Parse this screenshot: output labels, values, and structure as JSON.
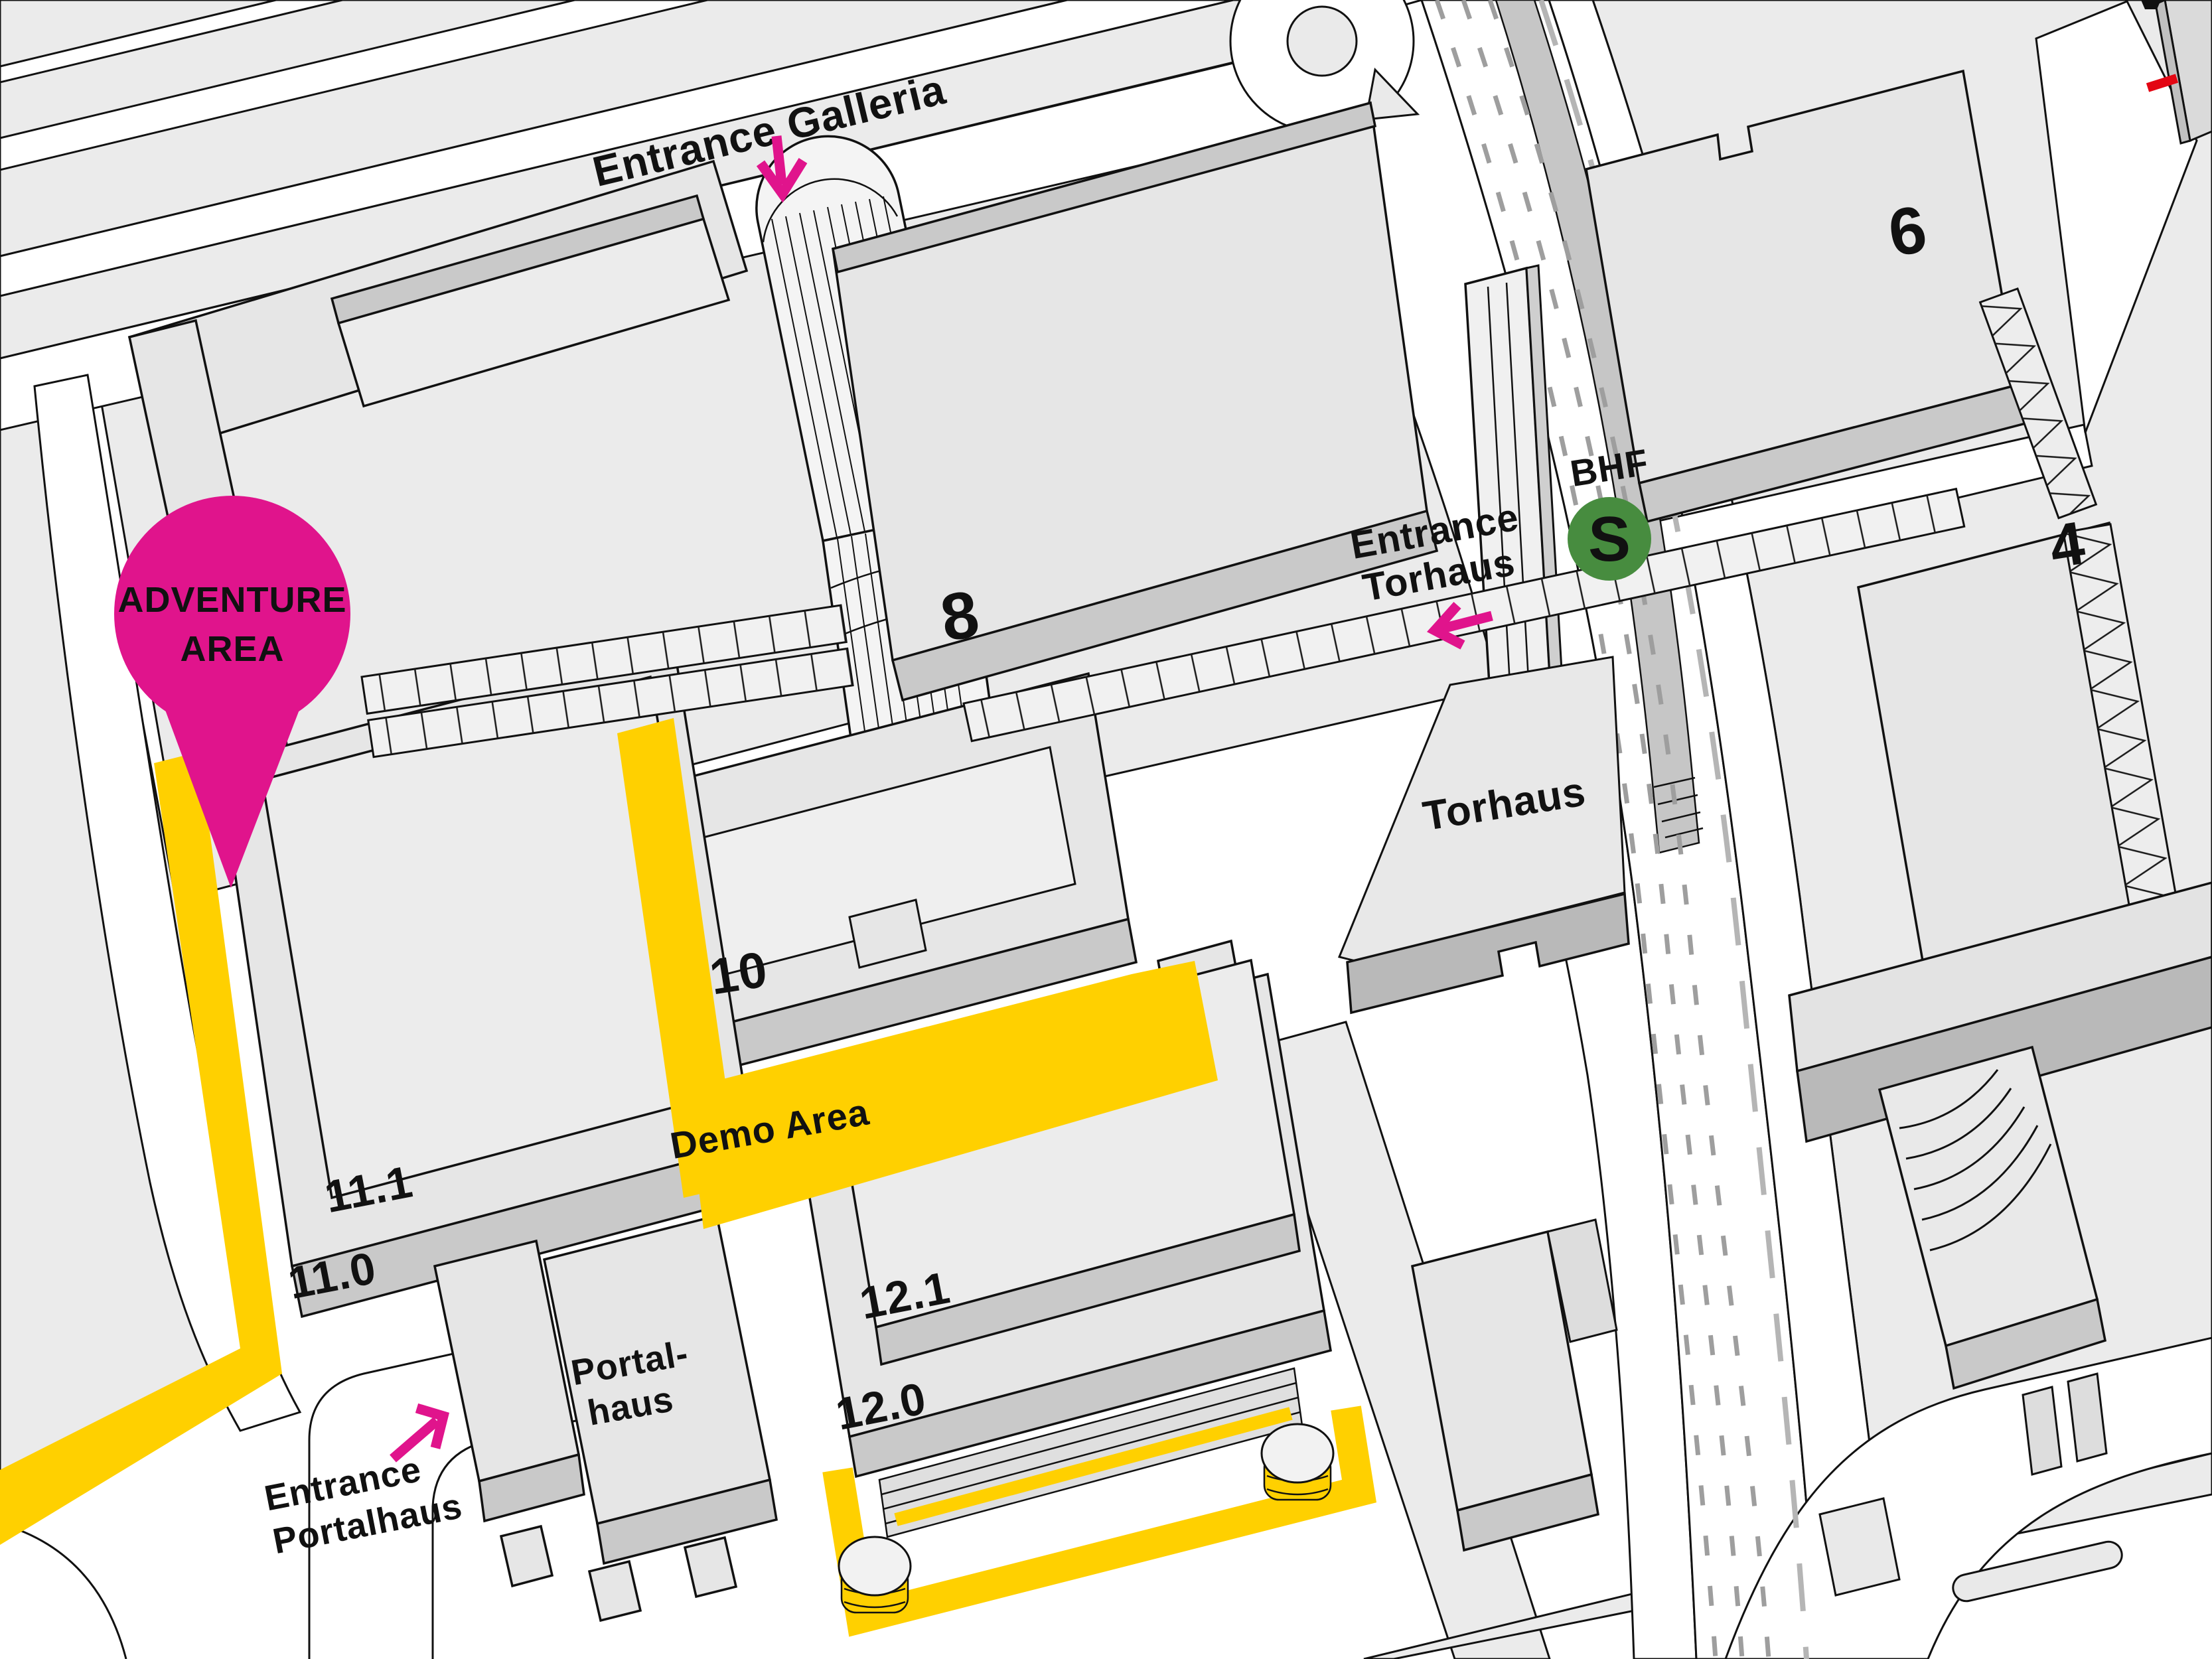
{
  "map": {
    "title": "Exhibition grounds overview map",
    "labels": {
      "entrance_galleria": "Entrance Galleria",
      "hall_9_0": "9.0",
      "hall_8": "8",
      "hall_6": "6",
      "hall_4": "4",
      "entrance_torhaus_line1": "Entrance",
      "entrance_torhaus_line2": "Torhaus",
      "bhf": "BHF",
      "sbahn": "S",
      "torhaus": "Torhaus",
      "pin_line1": "ADVENTURE",
      "pin_line2": "AREA",
      "hall_10": "10",
      "demo_area": "Demo Area",
      "hall_11_1": "11.1",
      "hall_11_0": "11.0",
      "portalhaus_line1": "Portal-",
      "portalhaus_line2": "haus",
      "entrance_portalhaus_line1": "Entrance",
      "entrance_portalhaus_line2": "Portalhaus",
      "hall_12_1": "12.1",
      "hall_12_0": "12.0"
    },
    "colors": {
      "accent_pink": "#E0148C",
      "route_yellow": "#FFD000",
      "sbahn_green": "#478C3F",
      "signal_red": "#E30613"
    }
  }
}
